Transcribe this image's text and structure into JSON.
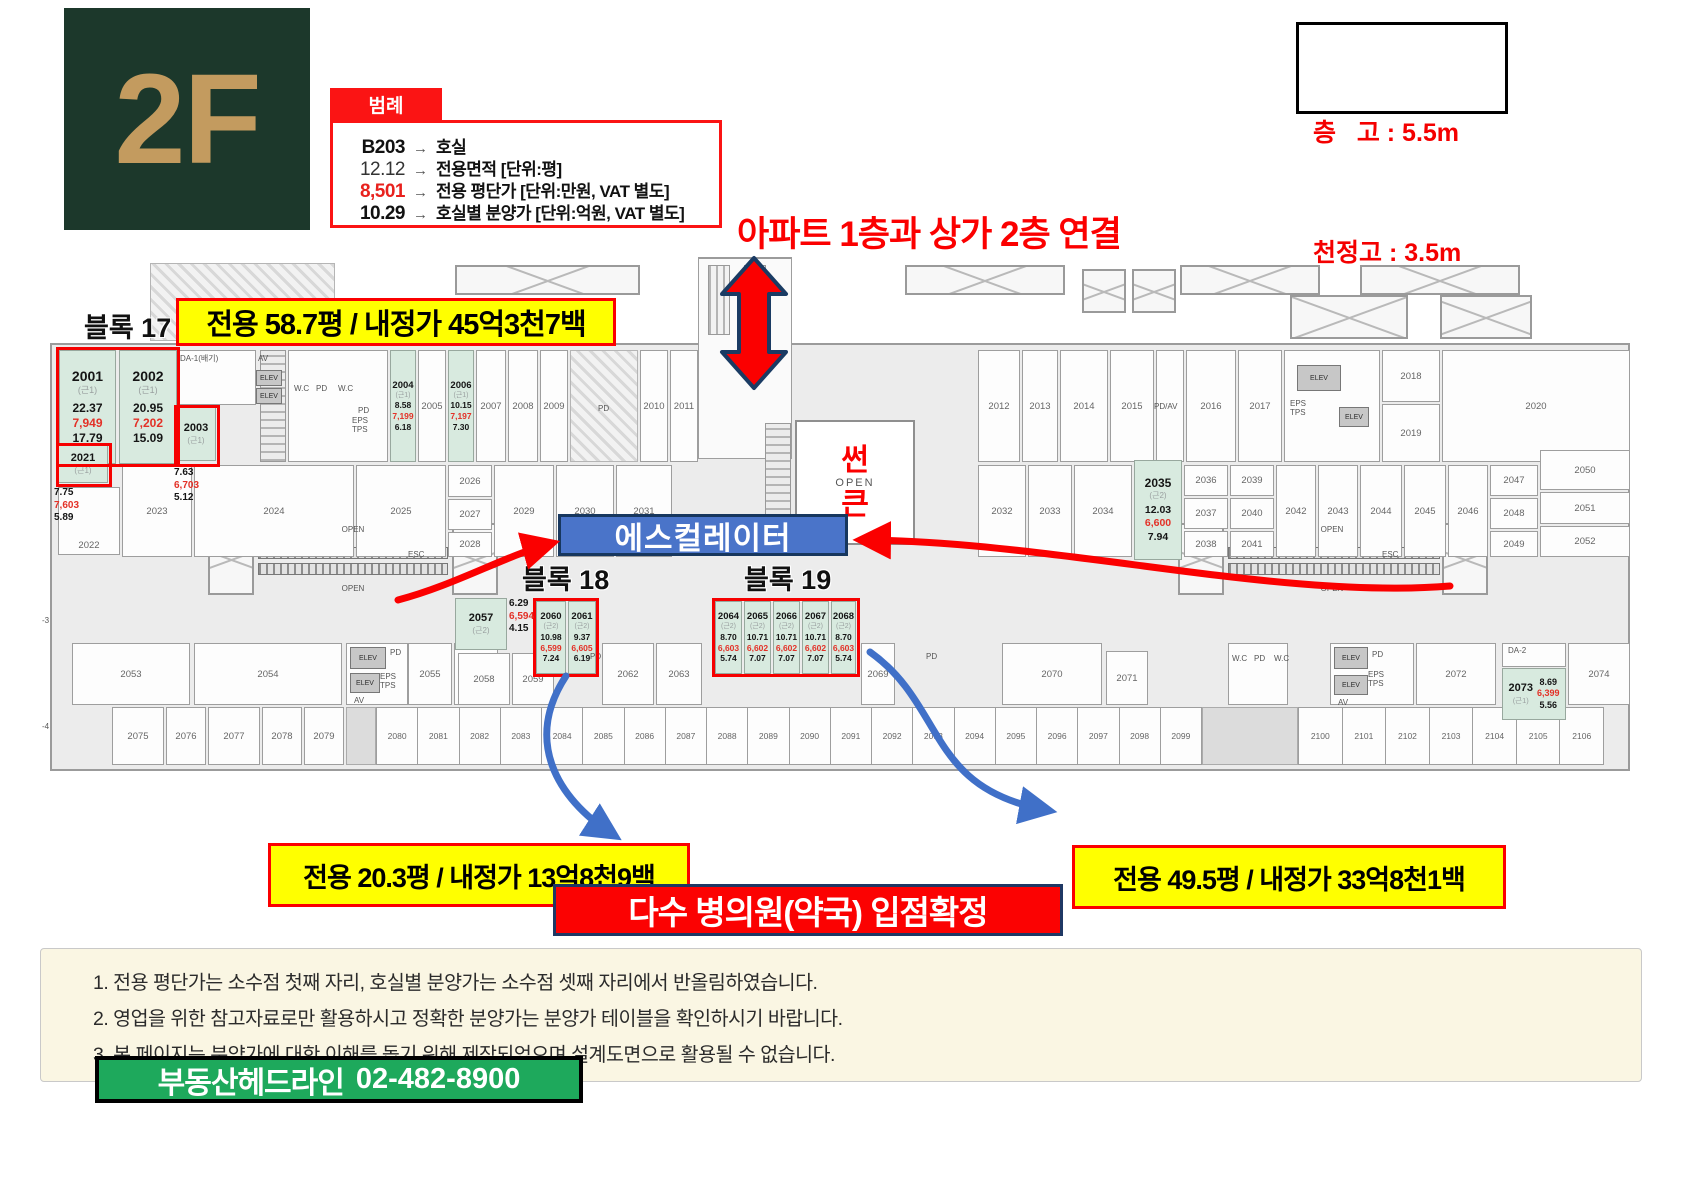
{
  "header": {
    "floor": "2F",
    "legend": {
      "tab": "범례",
      "arrow": "→",
      "rows": [
        {
          "value": "B203",
          "desc": "호실"
        },
        {
          "value": "12.12",
          "desc": "전용면적 [단위:평]"
        },
        {
          "value": "8,501",
          "desc": "전용 평단가 [단위:만원, VAT 별도]"
        },
        {
          "value": "10.29",
          "desc": "호실별 분양가 [단위:억원, VAT 별도]"
        }
      ]
    },
    "heights": {
      "floor_height": "층   고 : 5.5m",
      "ceiling_height": "천정고 : 3.5m"
    }
  },
  "annotations": {
    "bridge_note": "아파트 1층과 상가 2층 연결",
    "block17_callout": "전용 58.7평 / 내정가 45억3천7백",
    "block18_callout": "전용 20.3평 / 내정가 13억8천9백",
    "block19_callout": "전용 49.5평 / 내정가 33억8천1백",
    "escalator_label": "에스컬레이터",
    "sunken_1": "썬",
    "sunken_2": "큰",
    "confirmation": "다수 병의원(약국) 입점확정"
  },
  "blocks": {
    "block17": "블록 17",
    "block18": "블록 18",
    "block19": "블록 19"
  },
  "colors": {
    "accent_red": "#fb0000",
    "highlight_mint": "#d8eadf",
    "price_red": "#e33127",
    "escalator_blue": "#4a74c9",
    "brand_green": "#1ea95c",
    "callout_yellow": "#ffff00",
    "tile_green": "#1c382b",
    "tile_gold": "#c39b5f"
  },
  "plan": {
    "fac": {
      "wc": "W.C",
      "pd": "PD",
      "av": "AV",
      "elev": "ELEV",
      "eps_tps": "EPS\nTPS",
      "pdav": "PD/AV",
      "da1": "DA-1(배기)",
      "da2": "DA-2",
      "esc": "ESC",
      "open": "OPEN"
    },
    "edge_labels": [
      "-3",
      "-4"
    ],
    "units_highlight": [
      {
        "no": "2001",
        "use": "(근1)",
        "area": "22.37",
        "price": "7,949",
        "total": "17.79"
      },
      {
        "no": "2002",
        "use": "(근1)",
        "area": "20.95",
        "price": "7,202",
        "total": "15.09"
      },
      {
        "no": "2003",
        "use": "(근1)",
        "area": "7.63",
        "price": "6,703",
        "total": "5.12"
      },
      {
        "no": "2021",
        "use": "(근1)",
        "area": "7.75",
        "price": "7,603",
        "total": "5.89"
      },
      {
        "no": "2004",
        "use": "(근1)",
        "area": "8.58",
        "price": "7,199",
        "total": "6.18"
      },
      {
        "no": "2006",
        "use": "(근1)",
        "area": "10.15",
        "price": "7,197",
        "total": "7.30"
      },
      {
        "no": "2035",
        "use": "(근2)",
        "area": "12.03",
        "price": "6,600",
        "total": "7.94"
      },
      {
        "no": "2057",
        "use": "(근2)",
        "area": "6.29",
        "price": "6,594",
        "total": "4.15"
      },
      {
        "no": "2060",
        "use": "(근2)",
        "area": "10.98",
        "price": "6,599",
        "total": "7.24"
      },
      {
        "no": "2061",
        "use": "(근2)",
        "area": "9.37",
        "price": "6,605",
        "total": "6.19"
      },
      {
        "no": "2064",
        "use": "(근2)",
        "area": "8.70",
        "price": "6,603",
        "total": "5.74"
      },
      {
        "no": "2065",
        "use": "(근2)",
        "area": "10.71",
        "price": "6,602",
        "total": "7.07"
      },
      {
        "no": "2066",
        "use": "(근2)",
        "area": "10.71",
        "price": "6,602",
        "total": "7.07"
      },
      {
        "no": "2067",
        "use": "(근2)",
        "area": "10.71",
        "price": "6,602",
        "total": "7.07"
      },
      {
        "no": "2068",
        "use": "(근2)",
        "area": "8.70",
        "price": "6,603",
        "total": "5.74"
      },
      {
        "no": "2073",
        "use": "(근1)",
        "area": "8.69",
        "price": "6,399",
        "total": "5.56"
      }
    ],
    "units_plain": [
      "2005",
      "2007",
      "2008",
      "2009",
      "2010",
      "2011",
      "2012",
      "2013",
      "2014",
      "2015",
      "2016",
      "2017",
      "2018",
      "2019",
      "2020",
      "2022",
      "2023",
      "2024",
      "2025",
      "2026",
      "2027",
      "2028",
      "2029",
      "2030",
      "2031",
      "2032",
      "2033",
      "2034",
      "2036",
      "2037",
      "2038",
      "2039",
      "2040",
      "2041",
      "2042",
      "2043",
      "2044",
      "2045",
      "2046",
      "2047",
      "2048",
      "2049",
      "2050",
      "2051",
      "2052",
      "2053",
      "2054",
      "2055",
      "2056",
      "2058",
      "2059",
      "2062",
      "2063",
      "2069",
      "2070",
      "2071",
      "2072",
      "2074",
      "2075",
      "2076",
      "2077",
      "2078",
      "2079"
    ],
    "units_bottom_mid": [
      "2080",
      "2081",
      "2082",
      "2083",
      "2084",
      "2085",
      "2086",
      "2087",
      "2088",
      "2089",
      "2090",
      "2091",
      "2092",
      "2093",
      "2094",
      "2095",
      "2096",
      "2097",
      "2098",
      "2099"
    ],
    "units_bottom_right": [
      "2100",
      "2101",
      "2102",
      "2103",
      "2104",
      "2105",
      "2106"
    ]
  },
  "footer": {
    "notes": [
      "1. 전용 평단가는 소수점 첫째 자리, 호실별 분양가는 소수점 셋째 자리에서 반올림하였습니다.",
      "2. 영업을 위한 참고자료로만 활용하시고 정확한 분양가는 분양가 테이블을 확인하시기 바랍니다.",
      "3. 본 페이지는 분양가에 대한 이해를 돕기 위해 제작되었으며 설계도면으로 활용될 수 없습니다."
    ],
    "brand": "부동산헤드라인",
    "phone": "02-482-8900"
  }
}
